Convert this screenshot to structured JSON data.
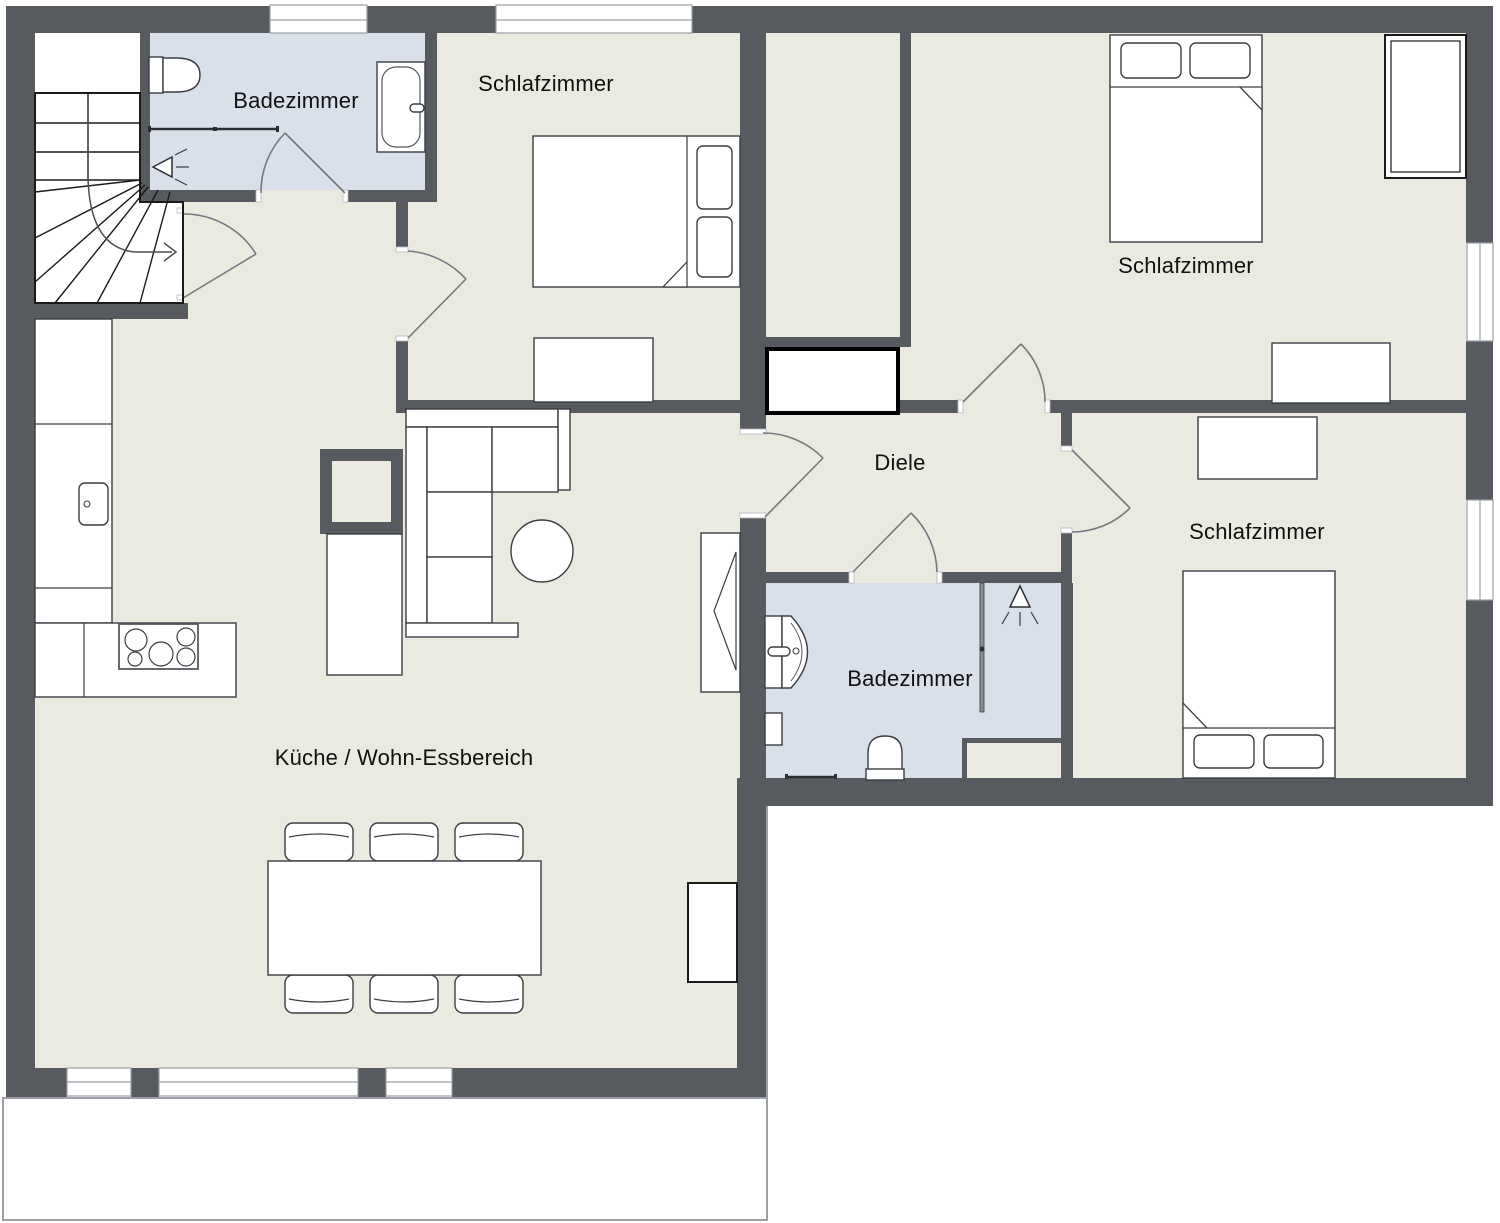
{
  "colors": {
    "wall": "#575b60",
    "floor": "#eaeae1",
    "bathroom_floor": "#d9e0ea",
    "outline": "#1a1a1a",
    "furniture_stroke": "#3a3e42",
    "door": "#75797e",
    "window_frame": "#9aa0a5",
    "terrace_border": "#9aa0a5",
    "label": "#111111",
    "background": "#ffffff"
  },
  "rooms": [
    {
      "id": "badezimmer-top",
      "label": "Badezimmer"
    },
    {
      "id": "schlafzimmer-top",
      "label": "Schlafzimmer"
    },
    {
      "id": "schlafzimmer-top-right",
      "label": "Schlafzimmer"
    },
    {
      "id": "diele",
      "label": "Diele"
    },
    {
      "id": "schlafzimmer-right",
      "label": "Schlafzimmer"
    },
    {
      "id": "badezimmer-middle",
      "label": "Badezimmer"
    },
    {
      "id": "kueche-wohnbereich",
      "label": "Küche / Wohn-Essbereich"
    }
  ]
}
